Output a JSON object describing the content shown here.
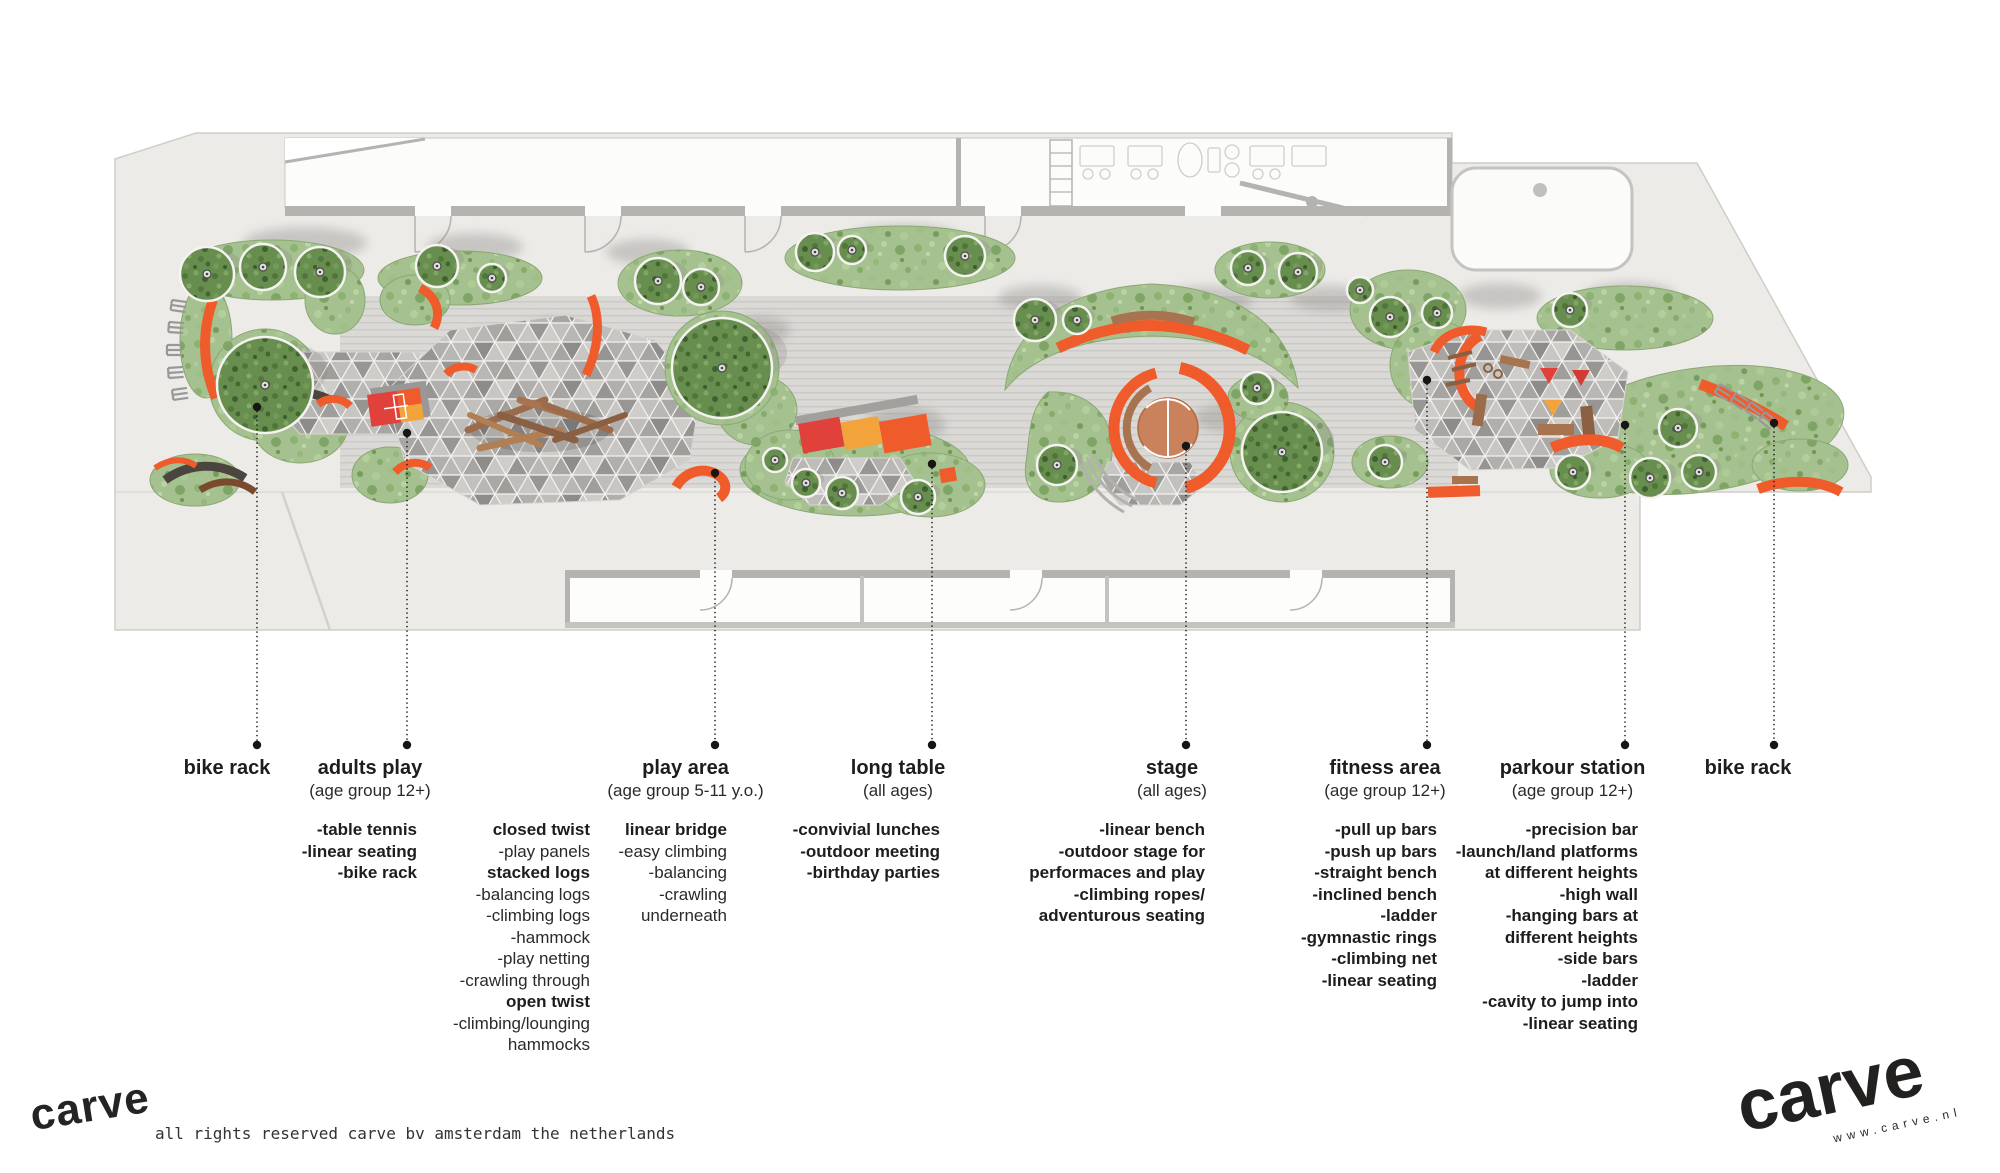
{
  "callouts": [
    {
      "id": "bike-rack-left",
      "title": "bike rack",
      "subtitle": ""
    },
    {
      "id": "adults-play",
      "title": "adults play",
      "subtitle": "(age group 12+)",
      "list": [
        "-table tennis",
        "-linear seating",
        "-bike rack"
      ]
    },
    {
      "id": "play-area",
      "title": "play area",
      "subtitle": "(age group 5-11 y.o.)",
      "list_left": [
        {
          "text": "closed twist",
          "bold": true
        },
        {
          "text": "-play panels"
        },
        {
          "text": "stacked logs",
          "bold": true
        },
        {
          "text": "-balancing logs"
        },
        {
          "text": "-climbing logs"
        },
        {
          "text": "-hammock"
        },
        {
          "text": "-play netting"
        },
        {
          "text": "-crawling through"
        },
        {
          "text": "open twist",
          "bold": true
        },
        {
          "text": "-climbing/lounging"
        },
        {
          "text": "hammocks"
        }
      ],
      "list_right": [
        {
          "text": "linear bridge",
          "bold": true
        },
        {
          "text": "-easy climbing"
        },
        {
          "text": "-balancing"
        },
        {
          "text": "-crawling"
        },
        {
          "text": "underneath"
        }
      ]
    },
    {
      "id": "long-table",
      "title": "long table",
      "subtitle": "(all ages)",
      "list": [
        "-convivial lunches",
        "-outdoor meeting",
        "-birthday parties"
      ]
    },
    {
      "id": "stage",
      "title": "stage",
      "subtitle": "(all ages)",
      "list": [
        "-linear bench",
        "-outdoor stage for",
        "performaces and play",
        "-climbing ropes/",
        "adventurous seating"
      ]
    },
    {
      "id": "fitness-area",
      "title": "fitness area",
      "subtitle": "(age group 12+)",
      "list": [
        "-pull up bars",
        "-push up bars",
        "-straight bench",
        "-inclined bench",
        "-ladder",
        "-gymnastic rings",
        "-climbing net",
        "-linear seating"
      ]
    },
    {
      "id": "parkour-station",
      "title": "parkour station",
      "subtitle": "(age group 12+)",
      "list": [
        "-precision bar",
        "-launch/land platforms",
        "at different heights",
        "-high wall",
        "-hanging bars at",
        "different heights",
        "-side bars",
        "-ladder",
        "-cavity to jump into",
        "-linear seating"
      ]
    },
    {
      "id": "bike-rack-right",
      "title": "bike rack",
      "subtitle": ""
    }
  ],
  "footer": {
    "logo_left": "carve",
    "rights": "all rights reserved carve bv amsterdam the netherlands",
    "logo_right": "carve",
    "website": "www.carve.nl"
  },
  "colors": {
    "orange": "#ef5b2b",
    "red": "#e0413a",
    "amber": "#f2a33c",
    "wood": "#a8734f",
    "grass": "#a6c190",
    "tree_green": "#678e4f",
    "paving_grey": "#b6b4b1",
    "site_grey": "#ecebe8",
    "leader_black": "#161616"
  }
}
